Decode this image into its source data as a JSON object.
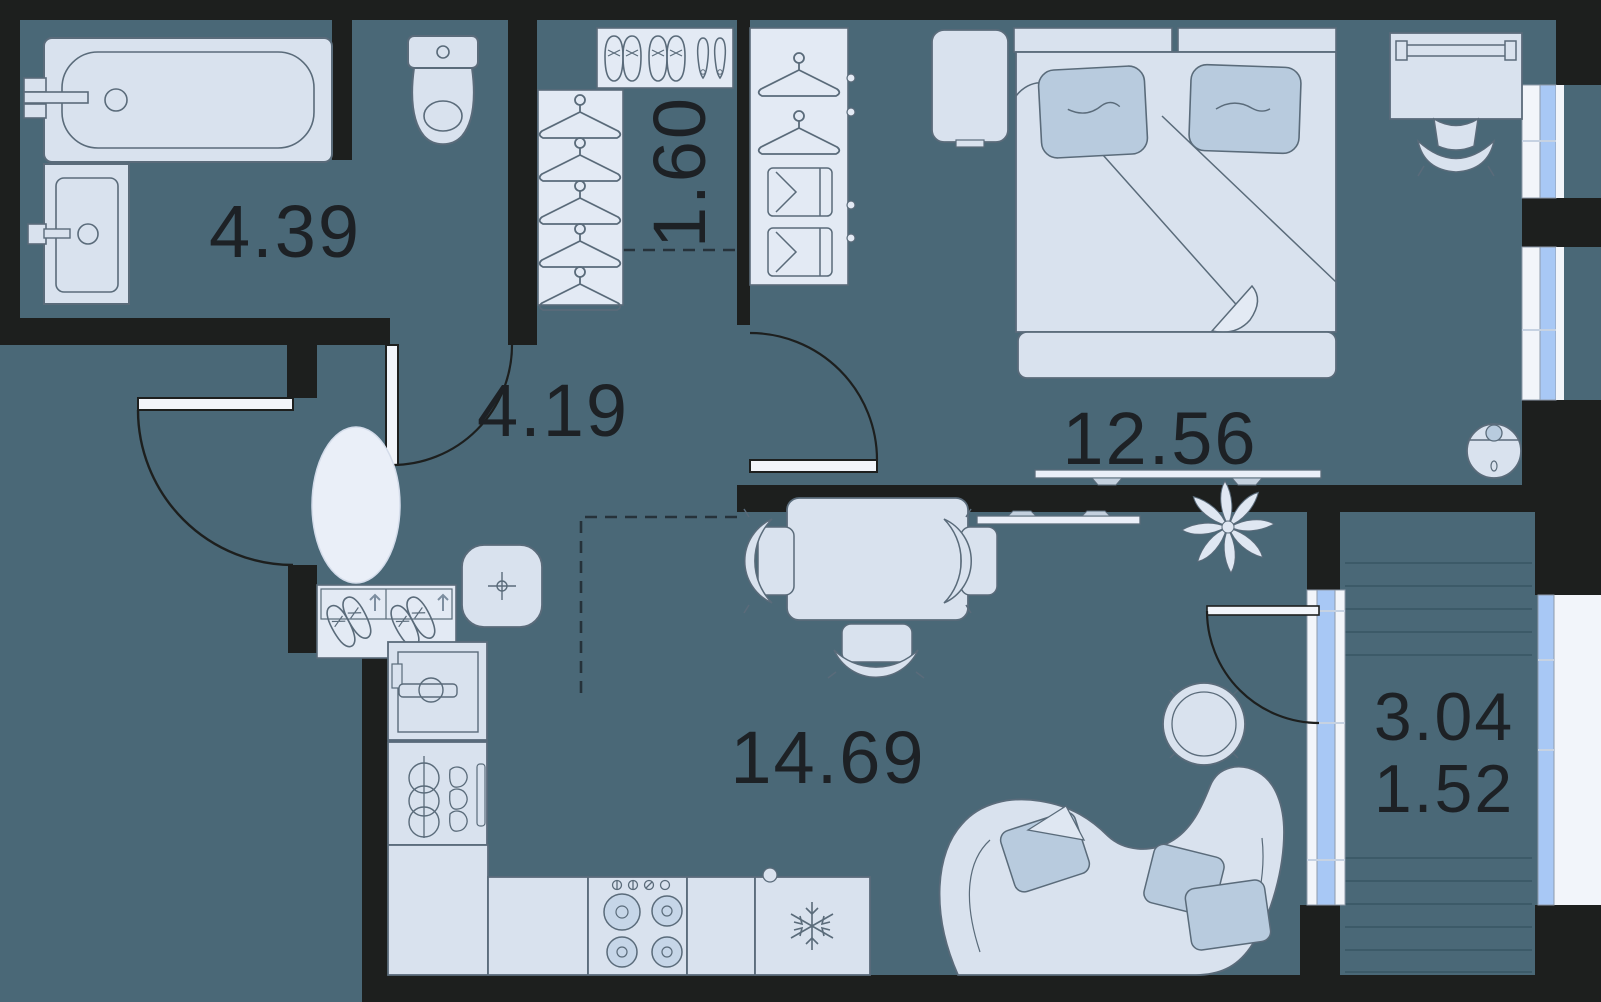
{
  "plan": {
    "type": "apartment-floor-plan",
    "colors": {
      "floor": "#4a6877",
      "wall": "#1d1f1e",
      "furniture_fill": "#d9e2ee",
      "furniture_light": "#eaeff8",
      "pillow_accent": "#b8cbde",
      "window_glass": "#a8c8f5",
      "window_frame": "#f2f5fa",
      "outline": "#5a6b7a",
      "deck_line": "#3c5a68",
      "label_text": "#1d2125"
    },
    "rooms": [
      {
        "name": "bathroom",
        "area_label": "4.39",
        "furniture": [
          "bathtub",
          "washbasin",
          "toilet"
        ]
      },
      {
        "name": "closet",
        "area_label": "1.60",
        "furniture": [
          "shoe-shelf",
          "wardrobe-hangers"
        ]
      },
      {
        "name": "hallway",
        "area_label": "4.19",
        "furniture": [
          "entry-door",
          "oval-rug",
          "shoe-rack",
          "pouf"
        ]
      },
      {
        "name": "bedroom",
        "area_label": "12.56",
        "furniture": [
          "double-bed",
          "pillows",
          "nightstand",
          "wardrobe",
          "desk",
          "desk-chair",
          "tv",
          "robot-vacuum"
        ]
      },
      {
        "name": "living-kitchen",
        "area_label": "14.69",
        "furniture": [
          "dining-table",
          "chairs",
          "sofa",
          "coffee-table",
          "plant",
          "tv",
          "washing-machine",
          "kitchen-sink",
          "stove",
          "fridge",
          "counter"
        ]
      },
      {
        "name": "balcony",
        "area_label": "3.04",
        "reduced_area_label": "1.52",
        "furniture": [
          "decking",
          "balcony-door",
          "windows"
        ]
      }
    ]
  }
}
